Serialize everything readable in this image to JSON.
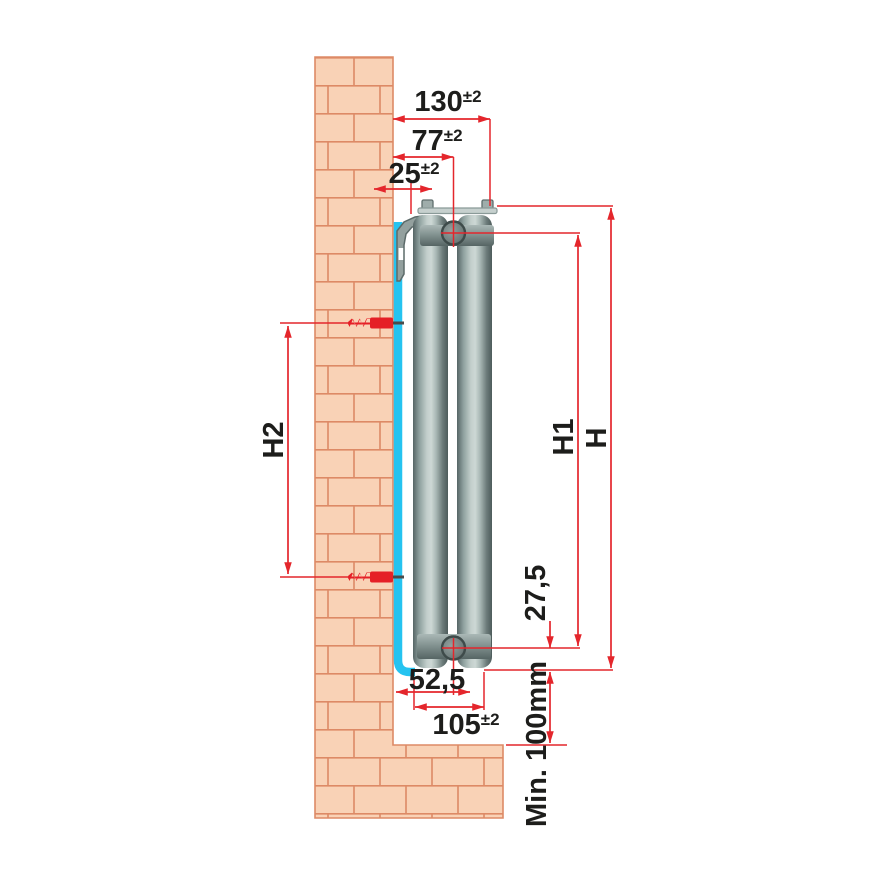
{
  "title": "Radiator side-view wall installation dimension drawing",
  "dimensions": {
    "depth_total": {
      "value": "130",
      "tolerance": "±2"
    },
    "wall_to_pipe_center": {
      "value": "77",
      "tolerance": "±2"
    },
    "wall_to_bracket": {
      "value": "25",
      "tolerance": "±2"
    },
    "panel_to_pipe_center": {
      "value": "52,5"
    },
    "depth_bottom": {
      "value": "105",
      "tolerance": "±2"
    },
    "pipe_center_to_bottom": {
      "value": "27,5"
    },
    "height_total": {
      "value": "H"
    },
    "height_pipe_centers": {
      "value": "H1"
    },
    "height_anchor_holes": {
      "value": "H2"
    },
    "floor_clearance": {
      "value": "Min. 100mm"
    }
  },
  "colors": {
    "dimension_red": "#e4262c",
    "anchor_red": "#e51f26",
    "mounting_rail_cyan": "#25c3f0",
    "brick_fill": "#f9d2b6",
    "brick_mortar": "#dd8a66",
    "radiator_gray": "#7f8f8d",
    "text": "#1d1d1b",
    "background": "#ffffff"
  }
}
